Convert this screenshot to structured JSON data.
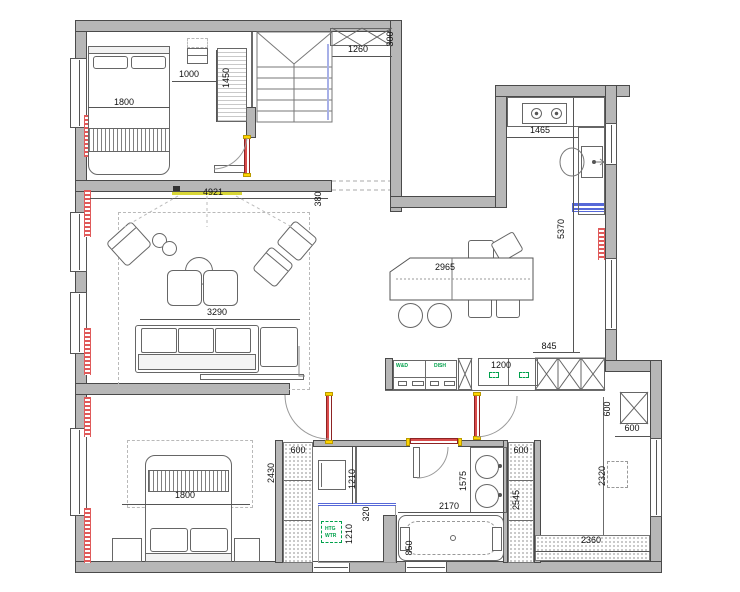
{
  "labels": {
    "dims": {
      "bed1_width": "1800",
      "bed1_gap": "1000",
      "wardrobe1_height": "1450",
      "hall_shelf": "1260",
      "hall_shelf_depth": "300",
      "living_width": "4921",
      "tv_wall_depth": "380",
      "kitchen_counter": "1465",
      "kitchen_wall": "5370",
      "dining_table": "2965",
      "sofa_zone": "3290",
      "kitchen_gap": "845",
      "kitchen_cabinet": "1200",
      "bed2_wardrobe": "600",
      "bed2_wardrobe_height": "2430",
      "bed2_width": "1800",
      "washer_zone": "1210",
      "shower_offset": "320",
      "shower_width": "1210",
      "bath_length": "2170",
      "vanity_length": "1575",
      "tub_width": "850",
      "bath_wardrobe": "600",
      "bath_wardrobe_height": "2545",
      "utility_column_v": "600",
      "utility_column_h": "600",
      "utility_niche": "2320",
      "utility_floor": "2360"
    },
    "appliances": {
      "washer_dryer": "W&D",
      "dishwasher": "DISH",
      "heater_line1": "HTG",
      "heater_line2": "WTR"
    }
  },
  "colors": {
    "wall": "#b7b7b7",
    "outline": "#4a4a4a",
    "thin": "#6b6b6b",
    "door": "#d94b4b",
    "yellow": "#ffd400",
    "tv": "#d8d636",
    "blue": "#5668d8",
    "windowblue": "#a7b0e8",
    "green": "#00a14b",
    "radiator": "#e05a5a"
  }
}
